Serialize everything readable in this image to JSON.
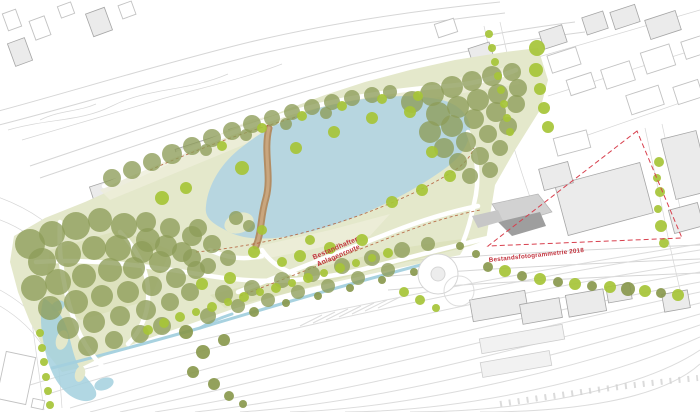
{
  "annotations": {
    "existing_path_label": {
      "line1": "Bestandhafter",
      "line2": "Anlagenroute"
    },
    "survey_area_label": "Bestandsfotogrammetrie 2018"
  },
  "colors": {
    "background": "#ffffff",
    "context_line": "#d6d6d6",
    "building_fill": "#ebebeb",
    "building_stroke": "#a6a6a6",
    "outline_building_stroke": "#c2c2c2",
    "lawn": "#e4e8cb",
    "lawn_dark": "#d8dfb6",
    "lawn_light": "#edeeda",
    "lake": "#b7d6e0",
    "stream": "#a3d0de",
    "canopy": "#8d9c58",
    "tree_bright": "#a6c437",
    "tree_dark": "#87974a",
    "path_white": "#ffffff",
    "bridge_tan": "#b28d64",
    "annotation_red": "#c2333e",
    "boundary_red": "#d8404e",
    "trace_brown": "#b05a35",
    "pavilion_gray": "#9e9e9e",
    "pavilion_light": "#d2d2d2"
  }
}
